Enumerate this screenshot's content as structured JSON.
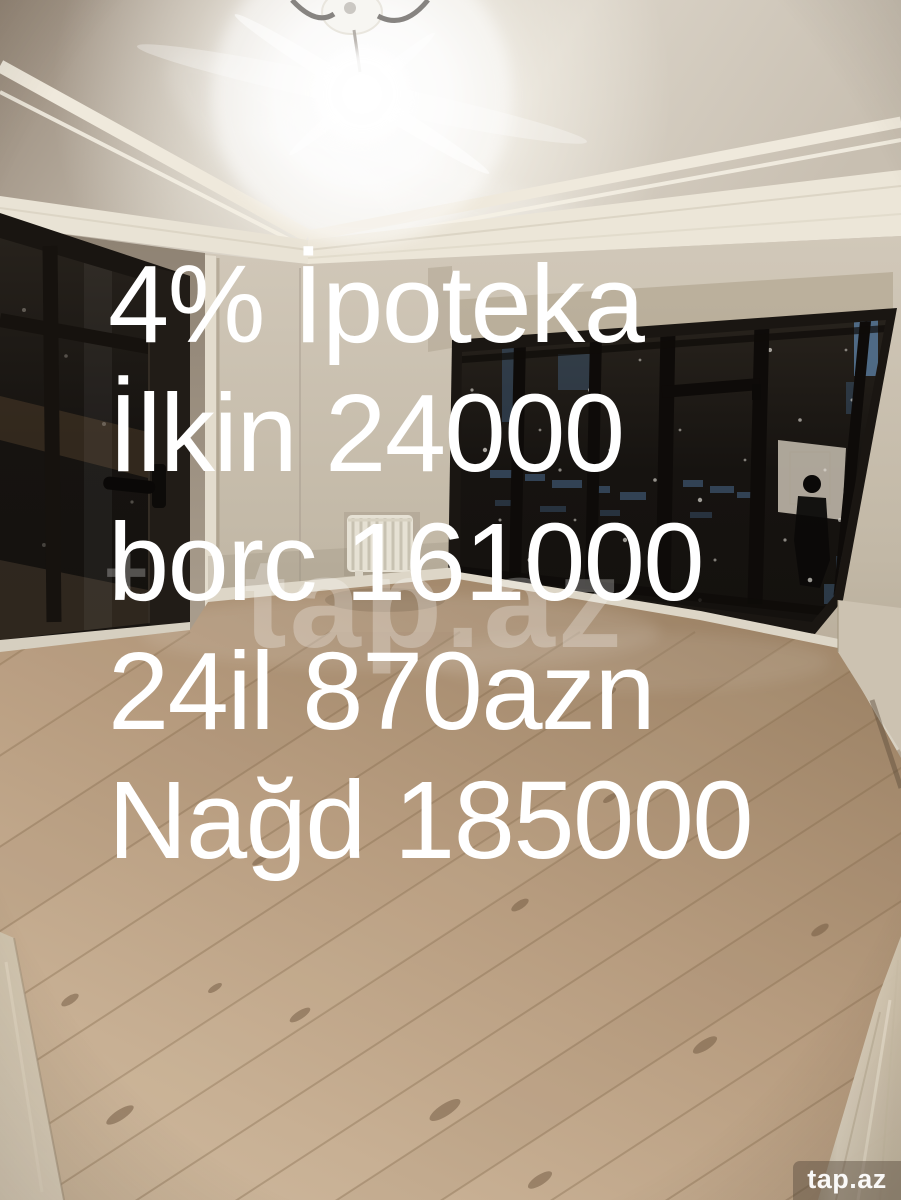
{
  "overlay": {
    "lines": [
      "4% İpoteka",
      "İlkin 24000",
      "borc 161000",
      "24il 870azn",
      "Nağd 185000"
    ],
    "color": "#ffffff"
  },
  "watermarks": {
    "center": {
      "plus": "+",
      "text": "tap.az"
    },
    "corner": {
      "text": "tap.az"
    }
  },
  "scene": {
    "colors": {
      "ceiling": "#cdc4b6",
      "molding": "#e9e3d5",
      "wall": "#c6bcab",
      "left_wall": "#9c9080",
      "frame": "#191511",
      "glass": "#171310",
      "floor": "#b79c80",
      "baseboard": "#ddd6c7",
      "radiator": "#e6e1d4",
      "glow": "#ffffff"
    }
  }
}
